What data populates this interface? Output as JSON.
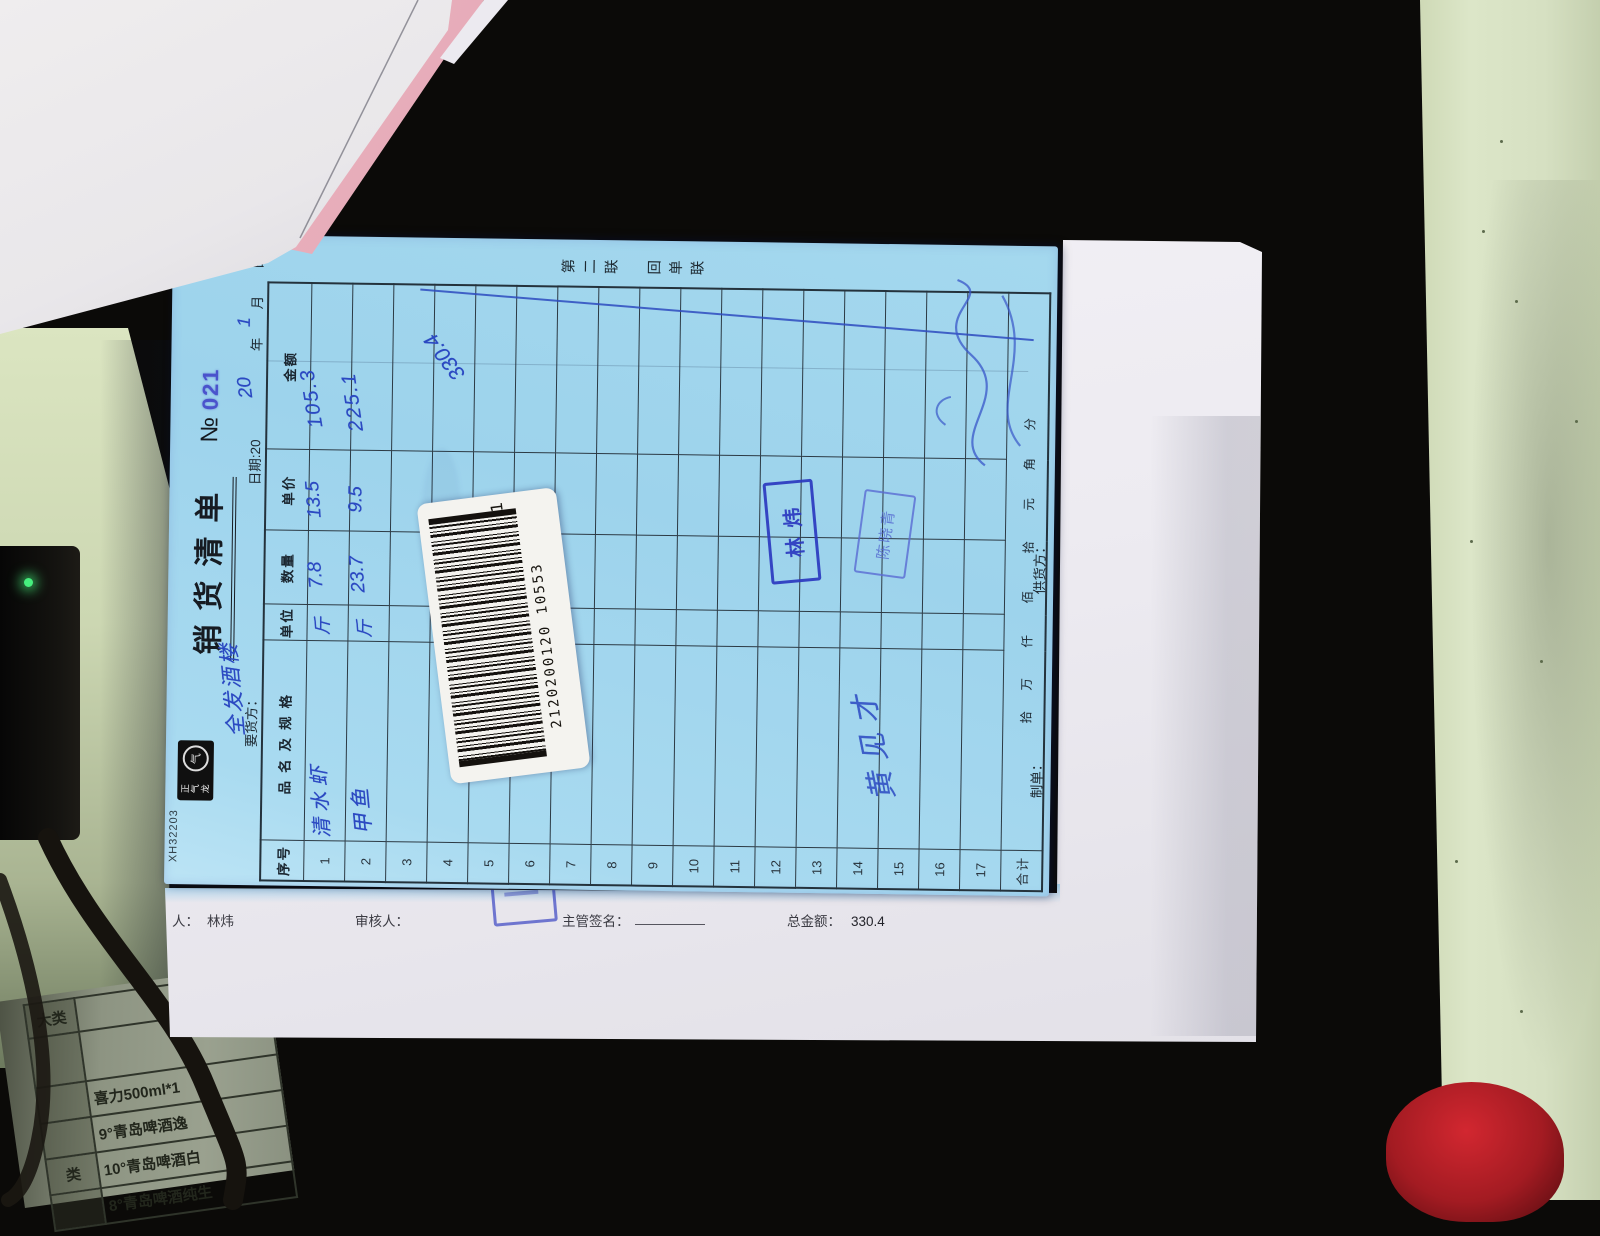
{
  "accent_colors": {
    "form_blue_paper": "#9dd3ec",
    "handwriting_ink": "#2b49c2",
    "stamp_blue": "#2c39c0",
    "serial_blue": "#4a53cc",
    "desk_mat_green": "#d6e0c2",
    "red_object": "#d22730"
  },
  "form": {
    "code": "XH32203",
    "logo_text": "正气龙",
    "logo_ring_text": "气",
    "title": "销货清单",
    "number_label": "№",
    "number": "021",
    "copy_label": "第二联　回单联",
    "customer_label": "要货方：",
    "customer_written": "全发酒楼",
    "date": {
      "prefix": "日期:20",
      "written_year": "20",
      "year_char": "年",
      "written_month": "1",
      "month_char": "月",
      "day_char": "日"
    },
    "table": {
      "headers": [
        "序号",
        "品名及规格",
        "单位",
        "数量",
        "单价",
        "金额"
      ],
      "row_count": 17,
      "row_numbers": [
        "1",
        "2",
        "3",
        "4",
        "5",
        "6",
        "7",
        "8",
        "9",
        "10",
        "11",
        "12",
        "13",
        "14",
        "15",
        "16",
        "17"
      ],
      "rows": [
        {
          "no": "1",
          "name": "清水虾",
          "unit": "斤",
          "qty": "7.8",
          "price": "13.5",
          "amount": "105.3"
        },
        {
          "no": "2",
          "name": "甲鱼",
          "unit": "斤",
          "qty": "23.7",
          "price": "9.5",
          "amount": "225.1"
        }
      ],
      "slash_note": "330.4",
      "total_label": "合计",
      "money_units": [
        "拾",
        "万",
        "仟",
        "佰",
        "拾",
        "元",
        "角",
        "分"
      ]
    },
    "footer": {
      "maker_label": "制单：",
      "supplier_label": "供货方：",
      "supplier_written_illegible": true
    },
    "signature_written": "黄见才",
    "stamps": [
      {
        "text": "林炜"
      },
      {
        "text": "陈晓青"
      }
    ],
    "barcode": {
      "number": "2120200120 10553",
      "suffix": "1"
    }
  },
  "under_sheet": {
    "maker_prefix": "人：",
    "maker_name": "林炜",
    "reviewer_label": "审核人：",
    "manager_sign_label": "主管签名：",
    "total_label": "总金额：",
    "total_value": "330.4"
  },
  "price_list": {
    "grid": [
      [
        "大类",
        ""
      ],
      [
        "",
        ""
      ],
      [
        "",
        "喜力500ml*1"
      ],
      [
        "",
        "9°青岛啤酒逸"
      ],
      [
        "类",
        "10°青岛啤酒白"
      ],
      [
        "",
        "8°青岛啤酒纯生"
      ]
    ]
  }
}
